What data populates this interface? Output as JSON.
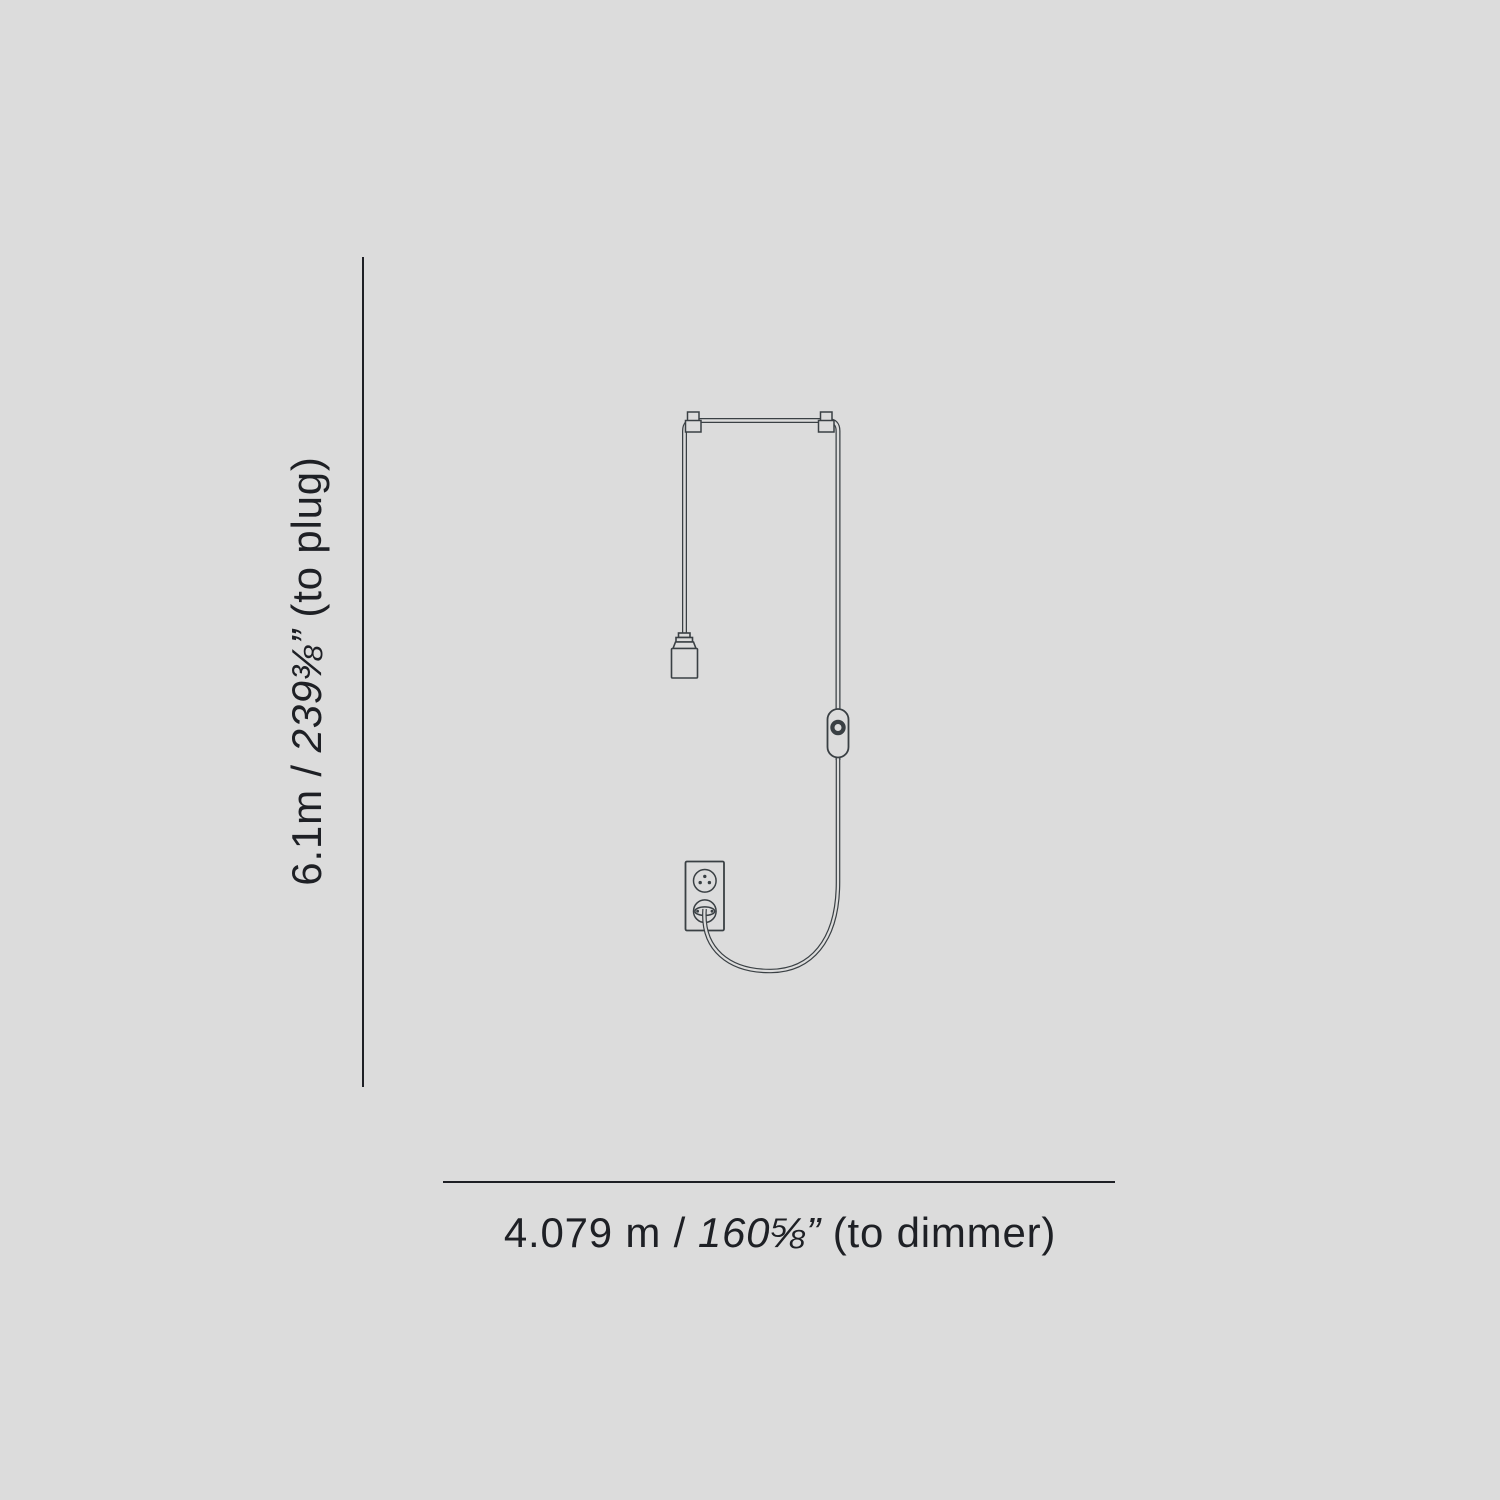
{
  "canvas": {
    "background": "#dcdcdc",
    "line_color": "#3a4044",
    "text_color": "#1e2025"
  },
  "vertical_dimension": {
    "metric": "6.1m /",
    "imperial": "239⅜”",
    "suffix": "(to plug)"
  },
  "horizontal_dimension": {
    "metric": "4.079 m /",
    "imperial": "160⅝”",
    "suffix": "(to dimmer)"
  },
  "drawing_parts": {
    "ceiling_track": "ceiling track with pendant cable",
    "bulb_socket": "bulb socket (open, no bulb)",
    "dimmer": "inline dimmer switch with dial",
    "outlet": "wall outlet, two sockets, plug inserted in lower socket"
  }
}
